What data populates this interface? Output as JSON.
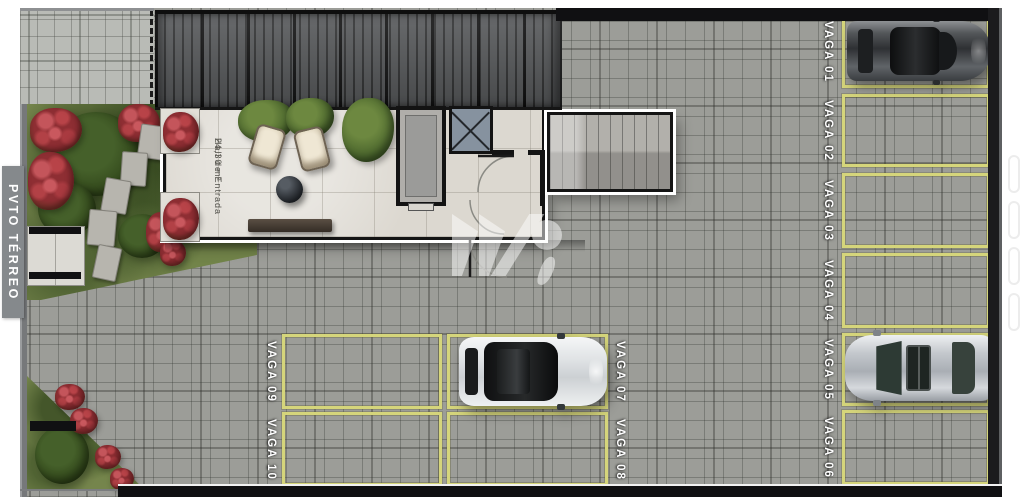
{
  "floor_label": "PVTO TÉRREO",
  "hall": {
    "name": "Hall de Entrada",
    "area": "24,30 m²"
  },
  "parking": {
    "spaces": [
      {
        "label": "VAGA 01",
        "occupied_by": "gray-coupe-car"
      },
      {
        "label": "VAGA 02",
        "occupied_by": null
      },
      {
        "label": "VAGA 03",
        "occupied_by": null
      },
      {
        "label": "VAGA 04",
        "occupied_by": null
      },
      {
        "label": "VAGA 05",
        "occupied_by": "silver-sedan-car"
      },
      {
        "label": "VAGA 06",
        "occupied_by": null
      },
      {
        "label": "VAGA 07",
        "occupied_by": "white-crossover-car"
      },
      {
        "label": "VAGA 08",
        "occupied_by": null
      },
      {
        "label": "VAGA 09",
        "occupied_by": null
      },
      {
        "label": "VAGA 10",
        "occupied_by": null
      }
    ]
  },
  "icons": {
    "elevator_shaft": "elevator-shaft-icon",
    "stair_shaft_x": "x-braced-shaft-icon",
    "logo_watermark": "studio-logo-watermark"
  },
  "colors": {
    "parking_line": "#d5d57b",
    "pavement": "#9c9d98",
    "sidewalk": "#b9bbb6",
    "grass": "#75854c",
    "flowers": "#a03a3f",
    "roof": "#57595b",
    "wall": "#101012",
    "floor_tag_bg": "#85898c"
  }
}
